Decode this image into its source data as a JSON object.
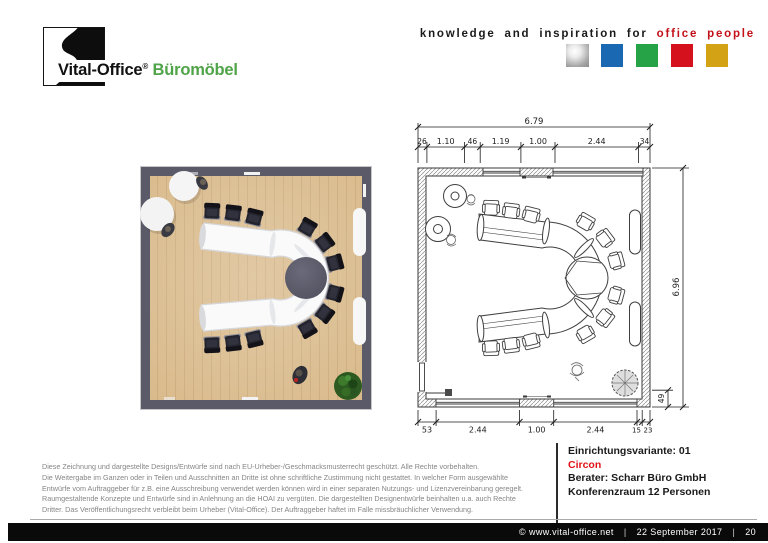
{
  "header": {
    "logo": {
      "brand": "Vital-Office",
      "registered": "®",
      "product": "Büromöbel",
      "product_color": "#4fa348"
    },
    "tagline_black": "knowledge and inspiration for",
    "tagline_red": "office people",
    "tagline_red_color": "#c41119",
    "color_squares": [
      {
        "name": "silver",
        "color": "#b9b9b9"
      },
      {
        "name": "blue",
        "color": "#1a68b2"
      },
      {
        "name": "green",
        "color": "#27a347"
      },
      {
        "name": "red",
        "color": "#d6111e"
      },
      {
        "name": "gold",
        "color": "#d4a315"
      }
    ]
  },
  "cad_plan": {
    "dim_total_width": "6.79",
    "dim_top_segments": [
      "26",
      "1.10",
      "46",
      "1.19",
      "1.00",
      "2.44",
      "34"
    ],
    "dim_bottom_segments": [
      "53",
      "2.44",
      "1.00",
      "2.44",
      "15",
      "23"
    ],
    "dim_total_height": "6.96",
    "dim_height_small": "49"
  },
  "footer": {
    "legal_lines": [
      "Diese Zeichnung und dargestellte Designs/Entwürfe sind nach EU-Urheber-/Geschmacksmusterrecht geschützt. Alle Rechte vorbehalten.",
      "Die Weitergabe im Ganzen oder in Teilen und Ausschnitten an Dritte ist ohne schriftliche Zustimmung nicht gestattet. In welcher Form ausgewählte",
      "Entwürfe vom Auftraggeber für z.B. eine Ausschreibung verwendet werden können wird in einer separaten Nutzungs- und Lizenzvereinbarung geregelt.",
      "Raumgestaltende Konzepte und Entwürfe sind in Anlehnung an die HOAI zu vergüten. Die dargestellten Designentwürfe beinhalten u.a. auch Rechte",
      "Dritter. Das Veröffentlichungsrecht verbleibt beim Urheber (Vital-Office). Der Auftraggeber haftet im Falle missbräuchlicher Verwendung."
    ],
    "info_variant": "Einrichtungsvariante: 01",
    "info_product": "Circon",
    "info_product_color": "#e01218",
    "info_consultant": "Berater: Scharr Büro GmbH",
    "info_room": "Konferenzraum 12 Personen"
  },
  "bottom_bar": {
    "copyright": "©  www.vital-office.net",
    "separator": "|",
    "date": "22 September 2017",
    "page": "20"
  }
}
